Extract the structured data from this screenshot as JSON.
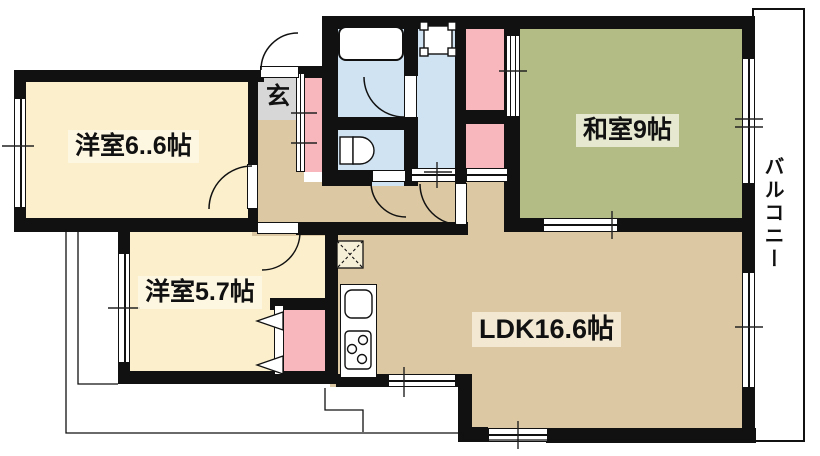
{
  "plan_type": "apartment-floor-plan",
  "rooms": {
    "western_6_6": {
      "label": "洋室6..6帖"
    },
    "japanese_9": {
      "label": "和室9帖"
    },
    "western_5_7": {
      "label": "洋室5.7帖"
    },
    "ldk": {
      "label": "LDK16.6帖"
    },
    "entrance": {
      "label": "玄"
    },
    "balcony": {
      "label": "バルコニー"
    }
  },
  "colors": {
    "wall": "#111111",
    "western_room": "#fbefcc",
    "japanese_room": "#b3bc85",
    "ldk_hall_floor": "#dcc8a3",
    "wet_area": "#cfe3f2",
    "closet_pink": "#f8b7bd",
    "entrance_gray": "#d7d7d7",
    "label_bg": "#fdf7e3"
  },
  "fixtures": [
    "bathtub",
    "washing-machine",
    "toilet",
    "kitchen-sink",
    "gas-stove",
    "ceiling-hatch"
  ]
}
